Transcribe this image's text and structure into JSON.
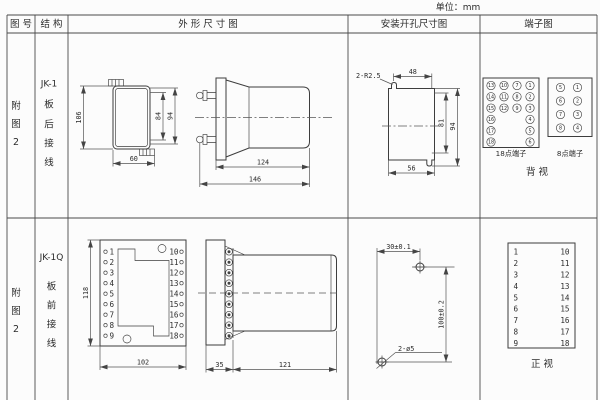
{
  "unit": "单位：mm",
  "colors": {
    "line": "#4a4a4a",
    "drawing": "#3d3d3d",
    "text": "#2b2b2b",
    "background": "#fcfcfc"
  },
  "header": {
    "fig": "图 号",
    "structure": "结 构",
    "outline": "外 形 尺 寸 图",
    "mounting": "安装开孔尺寸图",
    "terminal": "端子图"
  },
  "r1": {
    "fig": [
      "附",
      "图",
      "2"
    ],
    "structure": [
      "JK-1",
      "板",
      "后",
      "接",
      "线"
    ],
    "front": {
      "h": "106",
      "stud": "84",
      "case": "94",
      "w": "60"
    },
    "side": {
      "body": "124",
      "total": "146"
    },
    "cut": {
      "notch": "2-R2.5",
      "top": "48",
      "inner": "81",
      "outer": "94",
      "bottom": "56"
    },
    "t18": {
      "label": "18点端子",
      "c1": [
        "13",
        "14",
        "15",
        "16",
        "17",
        "18"
      ],
      "c2": [
        "10",
        "11",
        "12"
      ],
      "c3": [
        "7",
        "8",
        "9"
      ],
      "c4": [
        "1",
        "2",
        "3",
        "4",
        "5",
        "6"
      ]
    },
    "t8": {
      "label": "8点端子",
      "left": [
        "5",
        "6",
        "7",
        "8"
      ],
      "right": [
        "1",
        "2",
        "3",
        "4"
      ]
    },
    "view": "背  视"
  },
  "r2": {
    "fig": [
      "附",
      "图",
      "2"
    ],
    "structure": [
      "JK-1Q",
      "板",
      "前",
      "接",
      "线"
    ],
    "front": {
      "h": "118",
      "w": "102"
    },
    "side": {
      "flange": "35",
      "body": "121"
    },
    "holes": {
      "dx": "30±0.1",
      "dy": "100±0.2",
      "label": "2-ø5"
    },
    "pins": {
      "left": [
        "1",
        "2",
        "3",
        "4",
        "5",
        "6",
        "7",
        "8",
        "9"
      ],
      "right": [
        "10",
        "11",
        "12",
        "13",
        "14",
        "15",
        "16",
        "17",
        "18"
      ]
    },
    "view": "正  视"
  }
}
